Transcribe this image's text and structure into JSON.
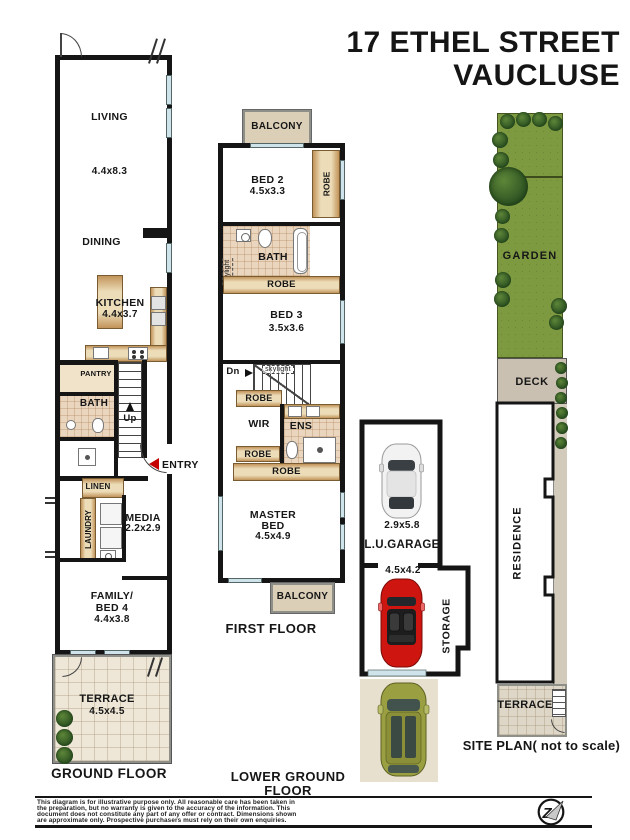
{
  "title": {
    "line1": "17 ETHEL STREET",
    "line2": "VAUCLUSE"
  },
  "colors": {
    "wall": "#151515",
    "timber": "#ecdcb8",
    "timber_edge": "#c2945a",
    "bath_tile": "#ead6bf",
    "terrace": "#eee7d8",
    "balcony": "#dbcfb8",
    "garden_green": "#7d9a41",
    "bush_green": "#2c5122",
    "deck_grey": "#c9c0b1",
    "window_blue": "#cfe4ea",
    "entry_red": "#c40000",
    "car_white": "#f2f2f2",
    "car_red": "#cf1510",
    "car_olive": "#9aa041"
  },
  "gf": {
    "label": "GROUND FLOOR",
    "living": "LIVING",
    "living_dims": "4.4x8.3",
    "dining": "DINING",
    "kitchen": "KITCHEN",
    "kitchen_dims": "4.4x3.7",
    "pantry": "PANTRY",
    "bath": "BATH",
    "up": "Up",
    "entry": "ENTRY",
    "linen": "LINEN",
    "laundry": "LAUNDRY",
    "media": "MEDIA",
    "media_dims": "2.2x2.9",
    "family1": "FAMILY/",
    "family2": "BED 4",
    "family_dims": "4.4x3.8",
    "terrace": "TERRACE",
    "terrace_dims": "4.5x4.5"
  },
  "ff": {
    "label": "FIRST FLOOR",
    "balcony_top": "BALCONY",
    "bed2": "BED 2",
    "bed2_dims": "4.5x3.3",
    "robe_side": "ROBE",
    "bath": "BATH",
    "skylight_side": "skylight",
    "skylight_stair": "skylight",
    "robe1": "ROBE",
    "bed3": "BED 3",
    "bed3_dims": "3.5x3.6",
    "dn": "Dn",
    "robe2": "ROBE",
    "wir": "WIR",
    "ens": "ENS",
    "robe3": "ROBE",
    "robe4": "ROBE",
    "master1": "MASTER",
    "master2": "BED",
    "master_dims": "4.5x4.9",
    "balcony_bottom": "BALCONY"
  },
  "lg": {
    "label": "LOWER GROUND FLOOR",
    "garage_dims1": "2.9x5.8",
    "garage": "L.U.GARAGE",
    "garage_dims2": "4.5x4.2",
    "storage": "STORAGE"
  },
  "sp": {
    "label": "SITE PLAN( not to scale)",
    "garden": "GARDEN",
    "deck": "DECK",
    "residence": "RESIDENCE",
    "terrace": "TERRACE"
  },
  "footer": {
    "line1": "This diagram is for illustrative purpose only. All reasonable care has been taken in",
    "line2": "the preparation, but no warranty is given to the accuracy of the information. This",
    "line3": "document does not constitute any part of any offer or contract. Dimensions shown",
    "line4": "are approximate only. Prospective purchasers must rely on their own enquiries.",
    "logo": "Z"
  }
}
